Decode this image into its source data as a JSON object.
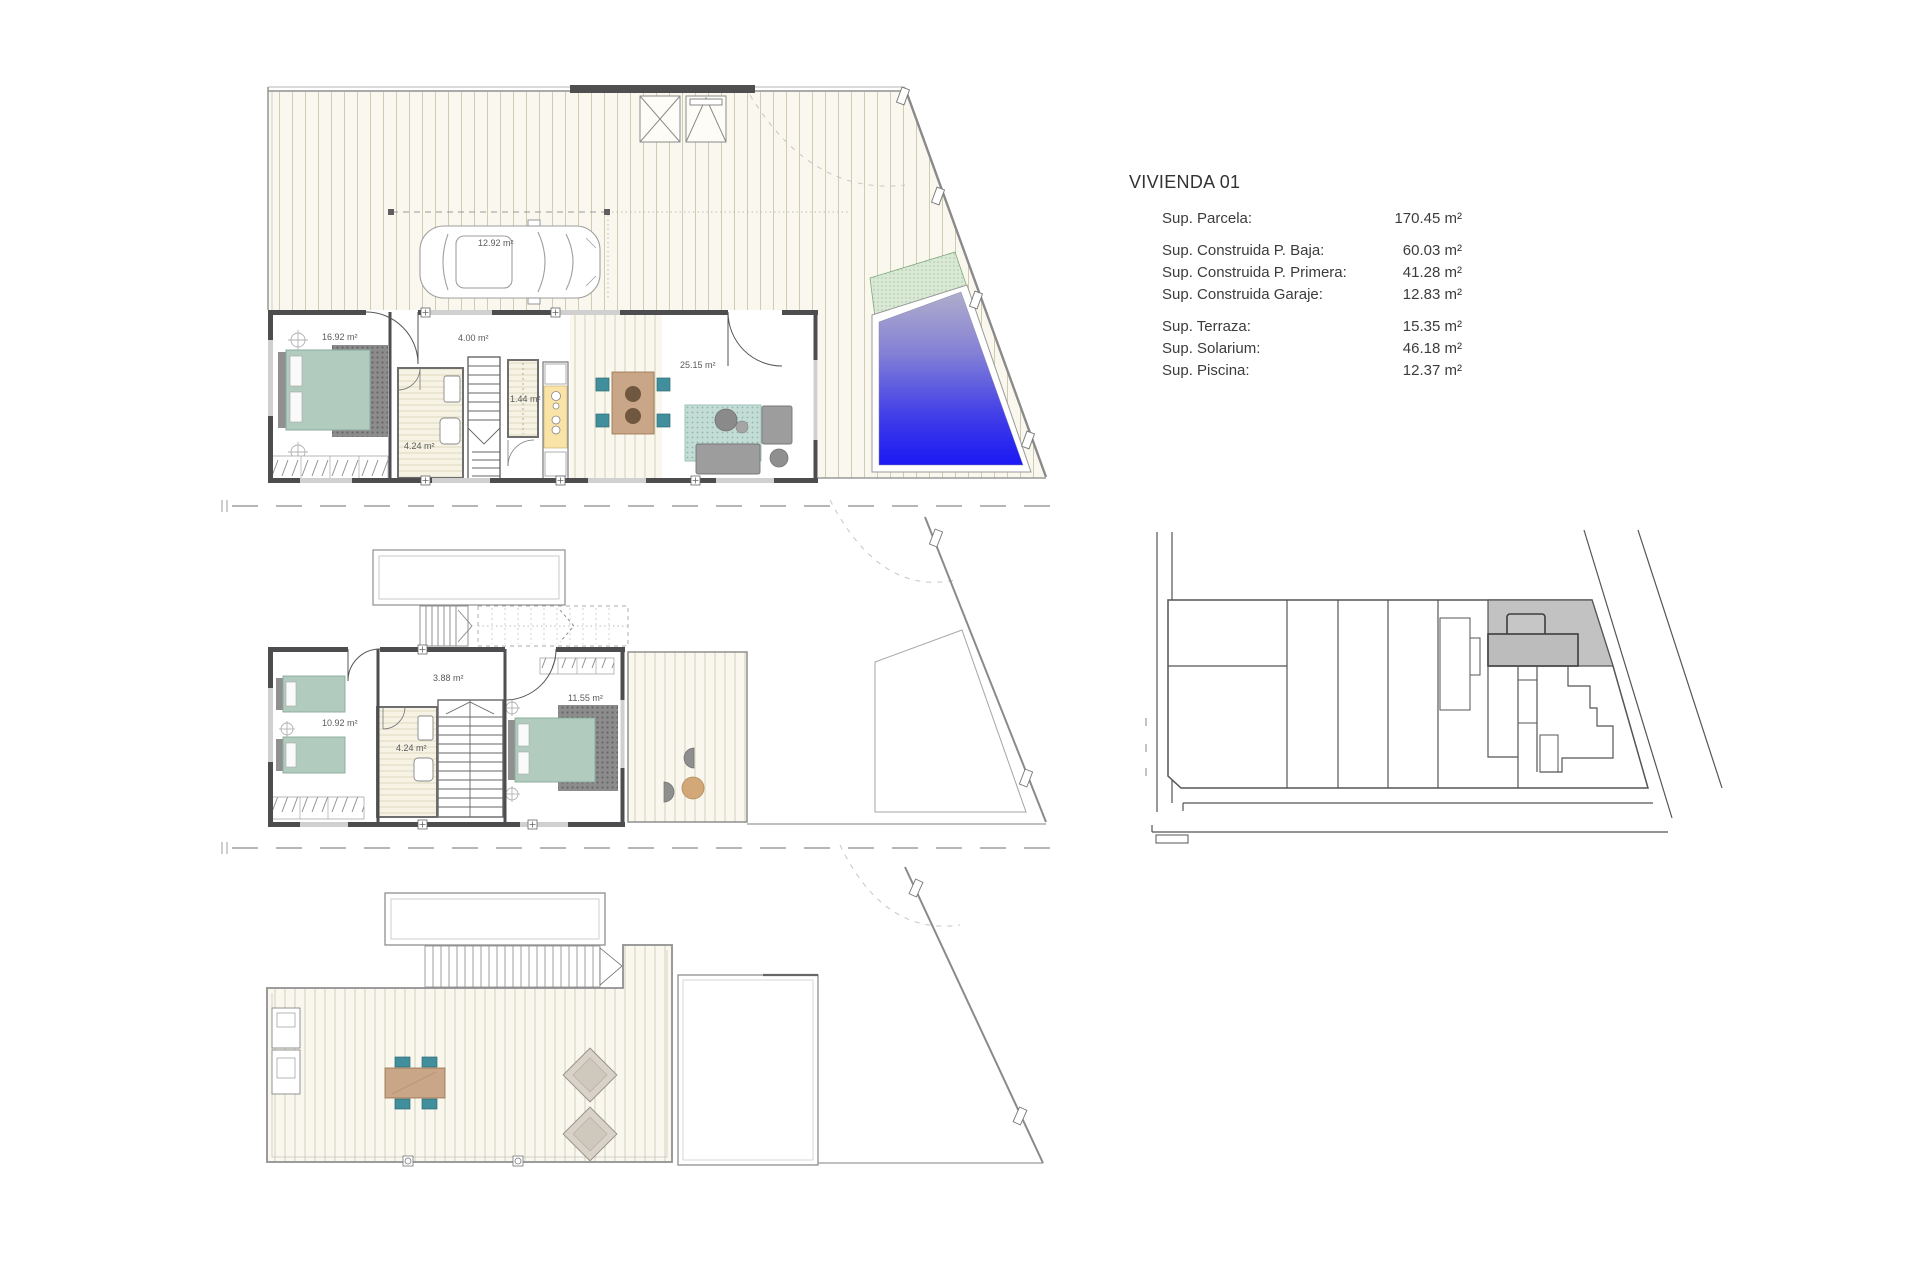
{
  "document": {
    "type": "architectural-plan-sheet"
  },
  "info_panel": {
    "title": "VIVIENDA 01",
    "rows": [
      {
        "label": "Sup. Parcela:",
        "value": "170.45 m²",
        "group_start": false
      },
      {
        "label": "Sup. Construida P. Baja:",
        "value": "60.03 m²",
        "group_start": true
      },
      {
        "label": "Sup. Construida P. Primera:",
        "value": "41.28 m²",
        "group_start": false
      },
      {
        "label": "Sup. Construida Garaje:",
        "value": "12.83 m²",
        "group_start": false
      },
      {
        "label": "Sup. Terraza:",
        "value": "15.35 m²",
        "group_start": true
      },
      {
        "label": "Sup. Solarium:",
        "value": "46.18 m²",
        "group_start": false
      },
      {
        "label": "Sup. Piscina:",
        "value": "12.37 m²",
        "group_start": false
      }
    ]
  },
  "plans": {
    "ground_floor": {
      "name": "Planta Baja",
      "labels": {
        "garage": "12.92 m²",
        "bedroom": "16.92 m²",
        "hall": "4.00 m²",
        "bathroom": "4.24 m²",
        "wc": "1.44 m²",
        "living": "25.15 m²"
      }
    },
    "first_floor": {
      "name": "Planta Primera",
      "labels": {
        "bedroom": "10.92 m²",
        "landing": "3.88 m²",
        "bathroom": "4.24 m²",
        "master": "11.55 m²"
      }
    },
    "roof": {
      "name": "Solarium"
    },
    "site_plan": {
      "name": "Emplazamiento"
    }
  },
  "colors": {
    "wall": "#4d4d50",
    "deck_bg": "#faf8ee",
    "deck_line": "#cfccb4",
    "pool_top": "#b0adcb",
    "pool_mid": "#8481d6",
    "pool_low": "#4340e8",
    "pool_deep": "#1b18f4",
    "green_band": "#d9e9d5",
    "bed_green": "#b2cbbf",
    "chair_teal": "#418e9c",
    "wood": "#c9a687",
    "wood_dark": "#6f583f",
    "table_round": "#d2a878",
    "lounger": "#d8d2c8",
    "rug_teal": "#c3ddd6",
    "parcel_gray": "#c2c2c2"
  }
}
